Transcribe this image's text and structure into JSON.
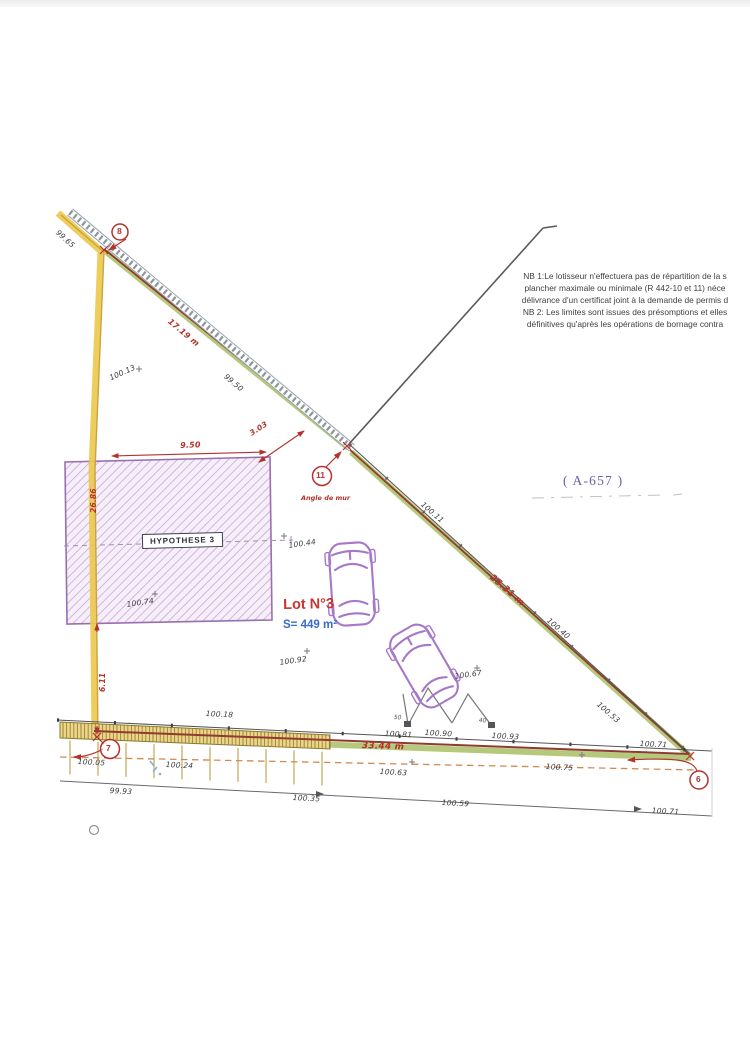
{
  "notes": {
    "line1": "NB 1:Le lotisseur n'effectuera pas de répartition de la s",
    "line2": "plancher maximale ou minimale (R 442-10 et 11) néce",
    "line3": "délivrance d'un certificat joint à la demande de permis d",
    "line4": "NB 2: Les limites sont issues des présomptions et elles",
    "line5": "définitives qu'après les opérations de bornage contra"
  },
  "parcel_ref": "( A-657 )",
  "lot": {
    "name": "Lot N°3",
    "area": "S= 449 m²"
  },
  "hypothesis": {
    "label": "HYPOTHESE 3"
  },
  "markers": {
    "p8": "8",
    "p11": "11",
    "p7": "7",
    "p6": "6",
    "angle_de_mur": "Angle de mur"
  },
  "dimensions": {
    "fence_length": "17.19 m",
    "rect_width": "9.50",
    "corner_offset": "3.03",
    "left_upper": "26.86",
    "left_lower": "6.11",
    "diagonal_length": "25.31 m",
    "street_length": "33.44 m",
    "gate_left": "50",
    "gate_right": "40"
  },
  "elevations": [
    "99.65",
    "100.13",
    "99.50",
    "100.11",
    "100.40",
    "100.53",
    "100.44",
    "100.74",
    "100.92",
    "100.67",
    "100.18",
    "100.81",
    "100.90",
    "100.93",
    "100.71",
    "100.05",
    "100.24",
    "100.63",
    "100.75",
    "99.93",
    "100.35",
    "100.59",
    "100.71"
  ],
  "colors": {
    "boundary_green": "#b6c87c",
    "boundary_red": "#8f3b2f",
    "highlight_yellow": "#ecc84e",
    "dimension_red": "#b4322c",
    "hatch_purple": "#c7a9d6",
    "lot_red": "#c9342e",
    "area_blue": "#3a6bc9",
    "ref_purple": "#6f5fa8"
  }
}
